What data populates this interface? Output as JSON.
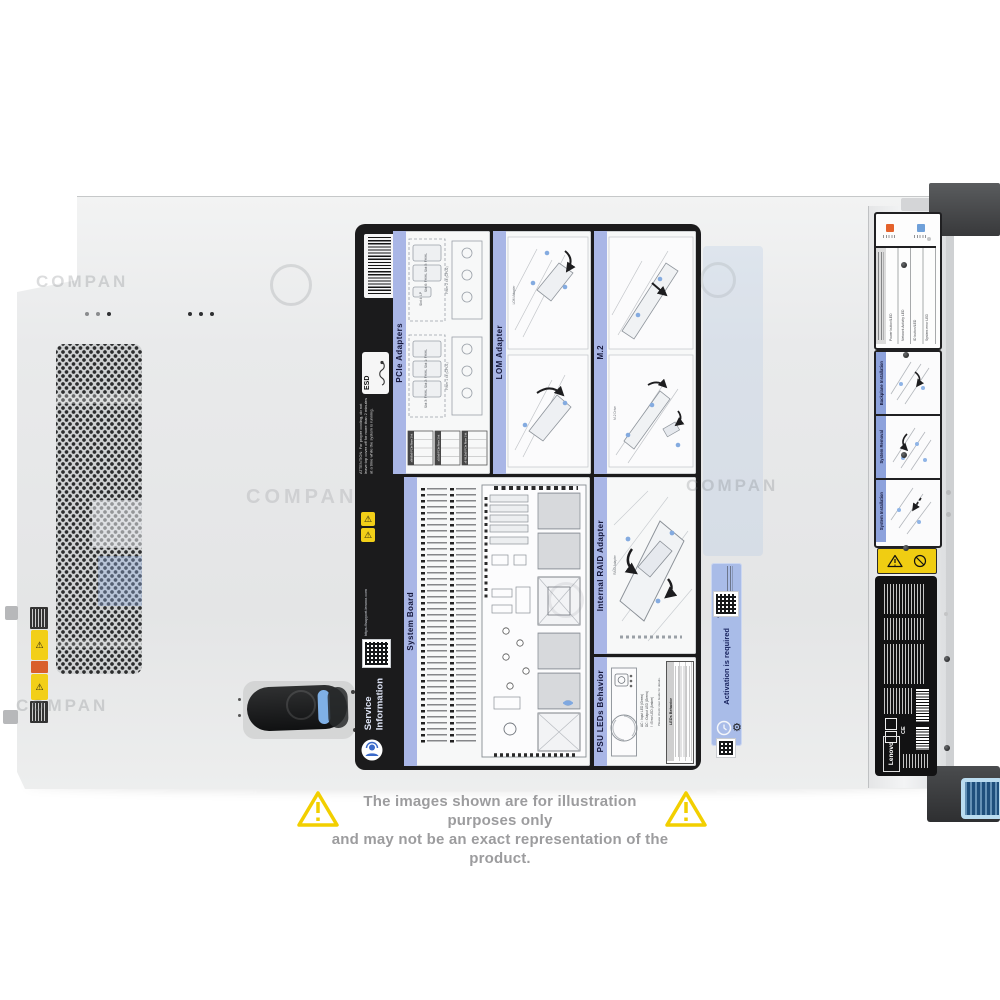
{
  "watermark": {
    "text": "COMPAN"
  },
  "disclaimer": {
    "line1": "The images shown are for illustration purposes only",
    "line2": "and may not be an exact representation of the product."
  },
  "colors": {
    "panel_title_blue": "#a9b6e6",
    "warning_yellow": "#f2cf00",
    "activation_blue": "#a9bce8",
    "latch_button_blue": "#badcf0",
    "chassis_gray": "#e9eaeb",
    "label_black": "#1b1b1c"
  },
  "service_label": {
    "brand_line1": "Service",
    "brand_line2": "Information",
    "support_url": "https://support.lenovo.com",
    "esd": "ESD",
    "attention": "ATTENTION: For proper cooling, do not leave top cover off for more than 2 minutes at a time while the system is running.",
    "panels": {
      "pcie": {
        "title": "PCIe Adapters",
        "riser1": "Riser 1 kit (CPU1)",
        "riser2": "Riser 2 kit (CPU2)",
        "slots": [
          "Slot 1: FH/HL",
          "Slot 2: FH/HL",
          "Slot 3: FH/HL",
          "Slot 4: LP",
          "Slot 5: FH/HL",
          "Slot 6: FH/HL"
        ],
        "tables": [
          "x8/x8/x8 PCIe Riser 1 kit",
          "x16/x8 PCIe Riser 1 kit",
          "x8 ML2/x8 PCIe Riser 1 kit"
        ]
      },
      "lom": {
        "title": "LOM Adapter",
        "callout": "LOM Adapter"
      },
      "m2": {
        "title": "M.2",
        "callout": "M.2 Drive"
      },
      "system_board": {
        "title": "System Board"
      },
      "raid": {
        "title": "Internal RAID Adapter",
        "callout": "RAID Adapter"
      },
      "psu": {
        "title": "PSU LEDs Behavior",
        "table_title": "LEDs Behavior",
        "legend": [
          "AC : Input LED (Green)",
          "DC : Output LED (Green)",
          "! : Error LED (Amber)"
        ],
        "note": "Please check User Guide for details."
      }
    }
  },
  "activation_label": {
    "title": "Activation is required",
    "url": "www.lenovo.com"
  },
  "rail": {
    "led_rows": [
      "Power button/LED",
      "Network Activity LED",
      "ID button/LED",
      "System error LED"
    ],
    "sections": [
      "Backplane Installation",
      "System Removal",
      "System Installation"
    ],
    "regulatory_brand": "Lenovo"
  }
}
